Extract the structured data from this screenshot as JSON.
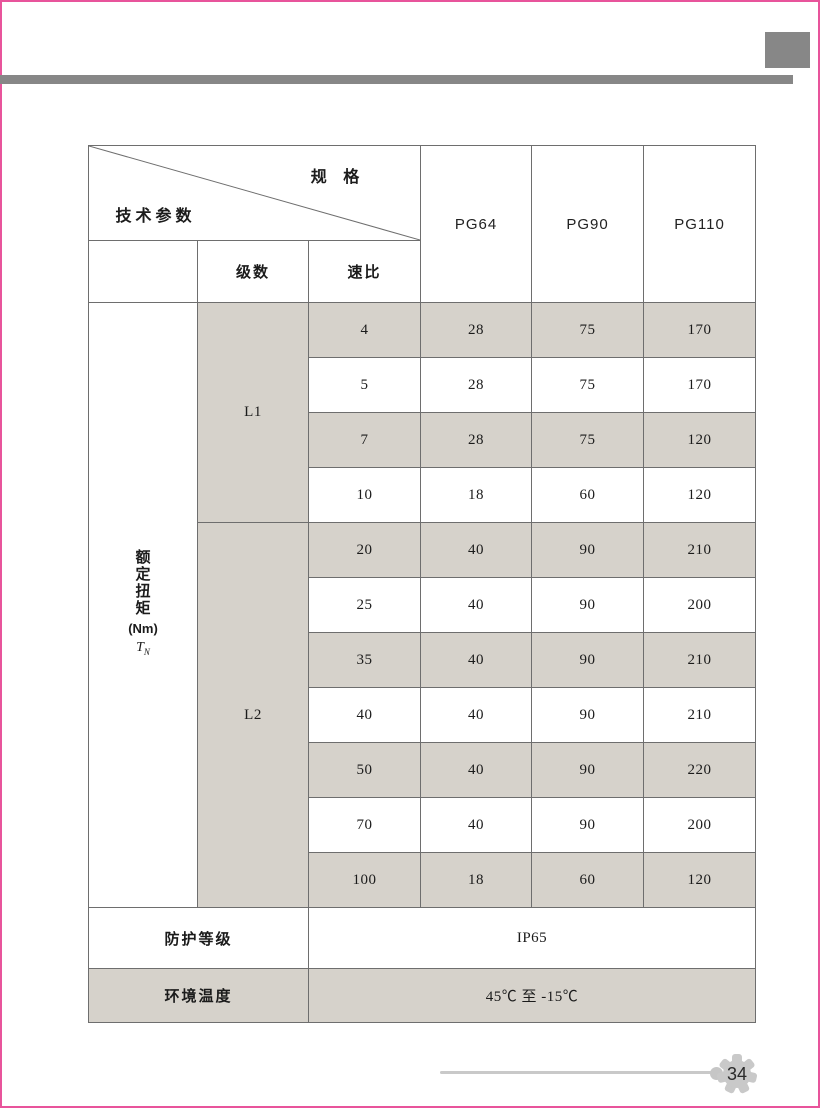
{
  "page": {
    "accent_pink": "#e8549b",
    "bar_gray": "#878787",
    "shade_gray": "#d6d2cb",
    "line_gray": "#6e6e6e",
    "footer_gray": "#c9c9c9",
    "page_number": "34"
  },
  "table": {
    "corner": {
      "top_right": "规 格",
      "bottom_left": "技术参数"
    },
    "columns": [
      "PG64",
      "PG90",
      "PG110"
    ],
    "subheaders": {
      "stage": "级数",
      "ratio": "速比"
    },
    "torque_label": {
      "chars": [
        "额",
        "定",
        "扭",
        "矩"
      ],
      "unit": "(Nm)",
      "symbol": "T",
      "symbol_sub": "N"
    },
    "groups": [
      {
        "stage": "L1",
        "rows": [
          {
            "ratio": "4",
            "pg64": "28",
            "pg90": "75",
            "pg110": "170"
          },
          {
            "ratio": "5",
            "pg64": "28",
            "pg90": "75",
            "pg110": "170"
          },
          {
            "ratio": "7",
            "pg64": "28",
            "pg90": "75",
            "pg110": "120"
          },
          {
            "ratio": "10",
            "pg64": "18",
            "pg90": "60",
            "pg110": "120"
          }
        ]
      },
      {
        "stage": "L2",
        "rows": [
          {
            "ratio": "20",
            "pg64": "40",
            "pg90": "90",
            "pg110": "210"
          },
          {
            "ratio": "25",
            "pg64": "40",
            "pg90": "90",
            "pg110": "200"
          },
          {
            "ratio": "35",
            "pg64": "40",
            "pg90": "90",
            "pg110": "210"
          },
          {
            "ratio": "40",
            "pg64": "40",
            "pg90": "90",
            "pg110": "210"
          },
          {
            "ratio": "50",
            "pg64": "40",
            "pg90": "90",
            "pg110": "220"
          },
          {
            "ratio": "70",
            "pg64": "40",
            "pg90": "90",
            "pg110": "200"
          },
          {
            "ratio": "100",
            "pg64": "18",
            "pg90": "60",
            "pg110": "120"
          }
        ]
      }
    ],
    "footer_rows": [
      {
        "label": "防护等级",
        "value": "IP65"
      },
      {
        "label": "环境温度",
        "value": "45℃ 至 -15℃"
      }
    ]
  }
}
